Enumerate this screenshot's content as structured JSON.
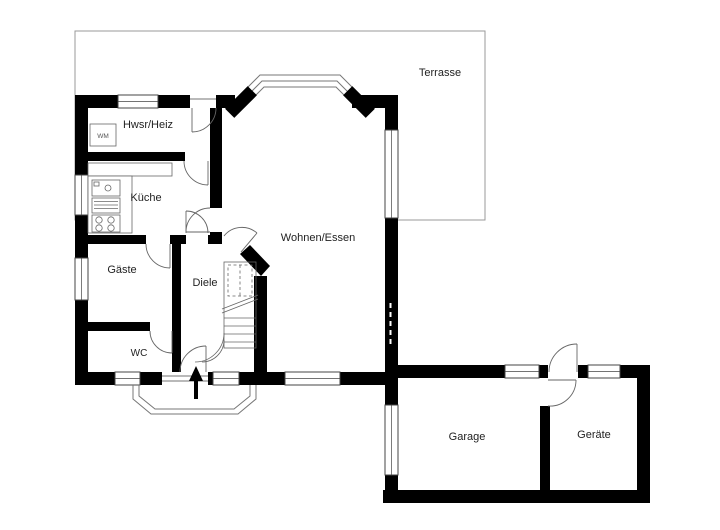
{
  "rooms": {
    "terrasse": {
      "label": "Terrasse"
    },
    "hwsr": {
      "label": "Hwsr/Heiz"
    },
    "kueche": {
      "label": "Küche"
    },
    "gaeste": {
      "label": "Gäste"
    },
    "diele": {
      "label": "Diele"
    },
    "wc": {
      "label": "WC"
    },
    "wohnen": {
      "label": "Wohnen/Essen"
    },
    "garage": {
      "label": "Garage"
    },
    "geraete": {
      "label": "Geräte"
    }
  },
  "fixtures": {
    "washing_machine": {
      "label": "WM"
    }
  },
  "colors": {
    "wall": "#000000",
    "outline": "#888888",
    "background": "#ffffff",
    "text": "#222222"
  }
}
